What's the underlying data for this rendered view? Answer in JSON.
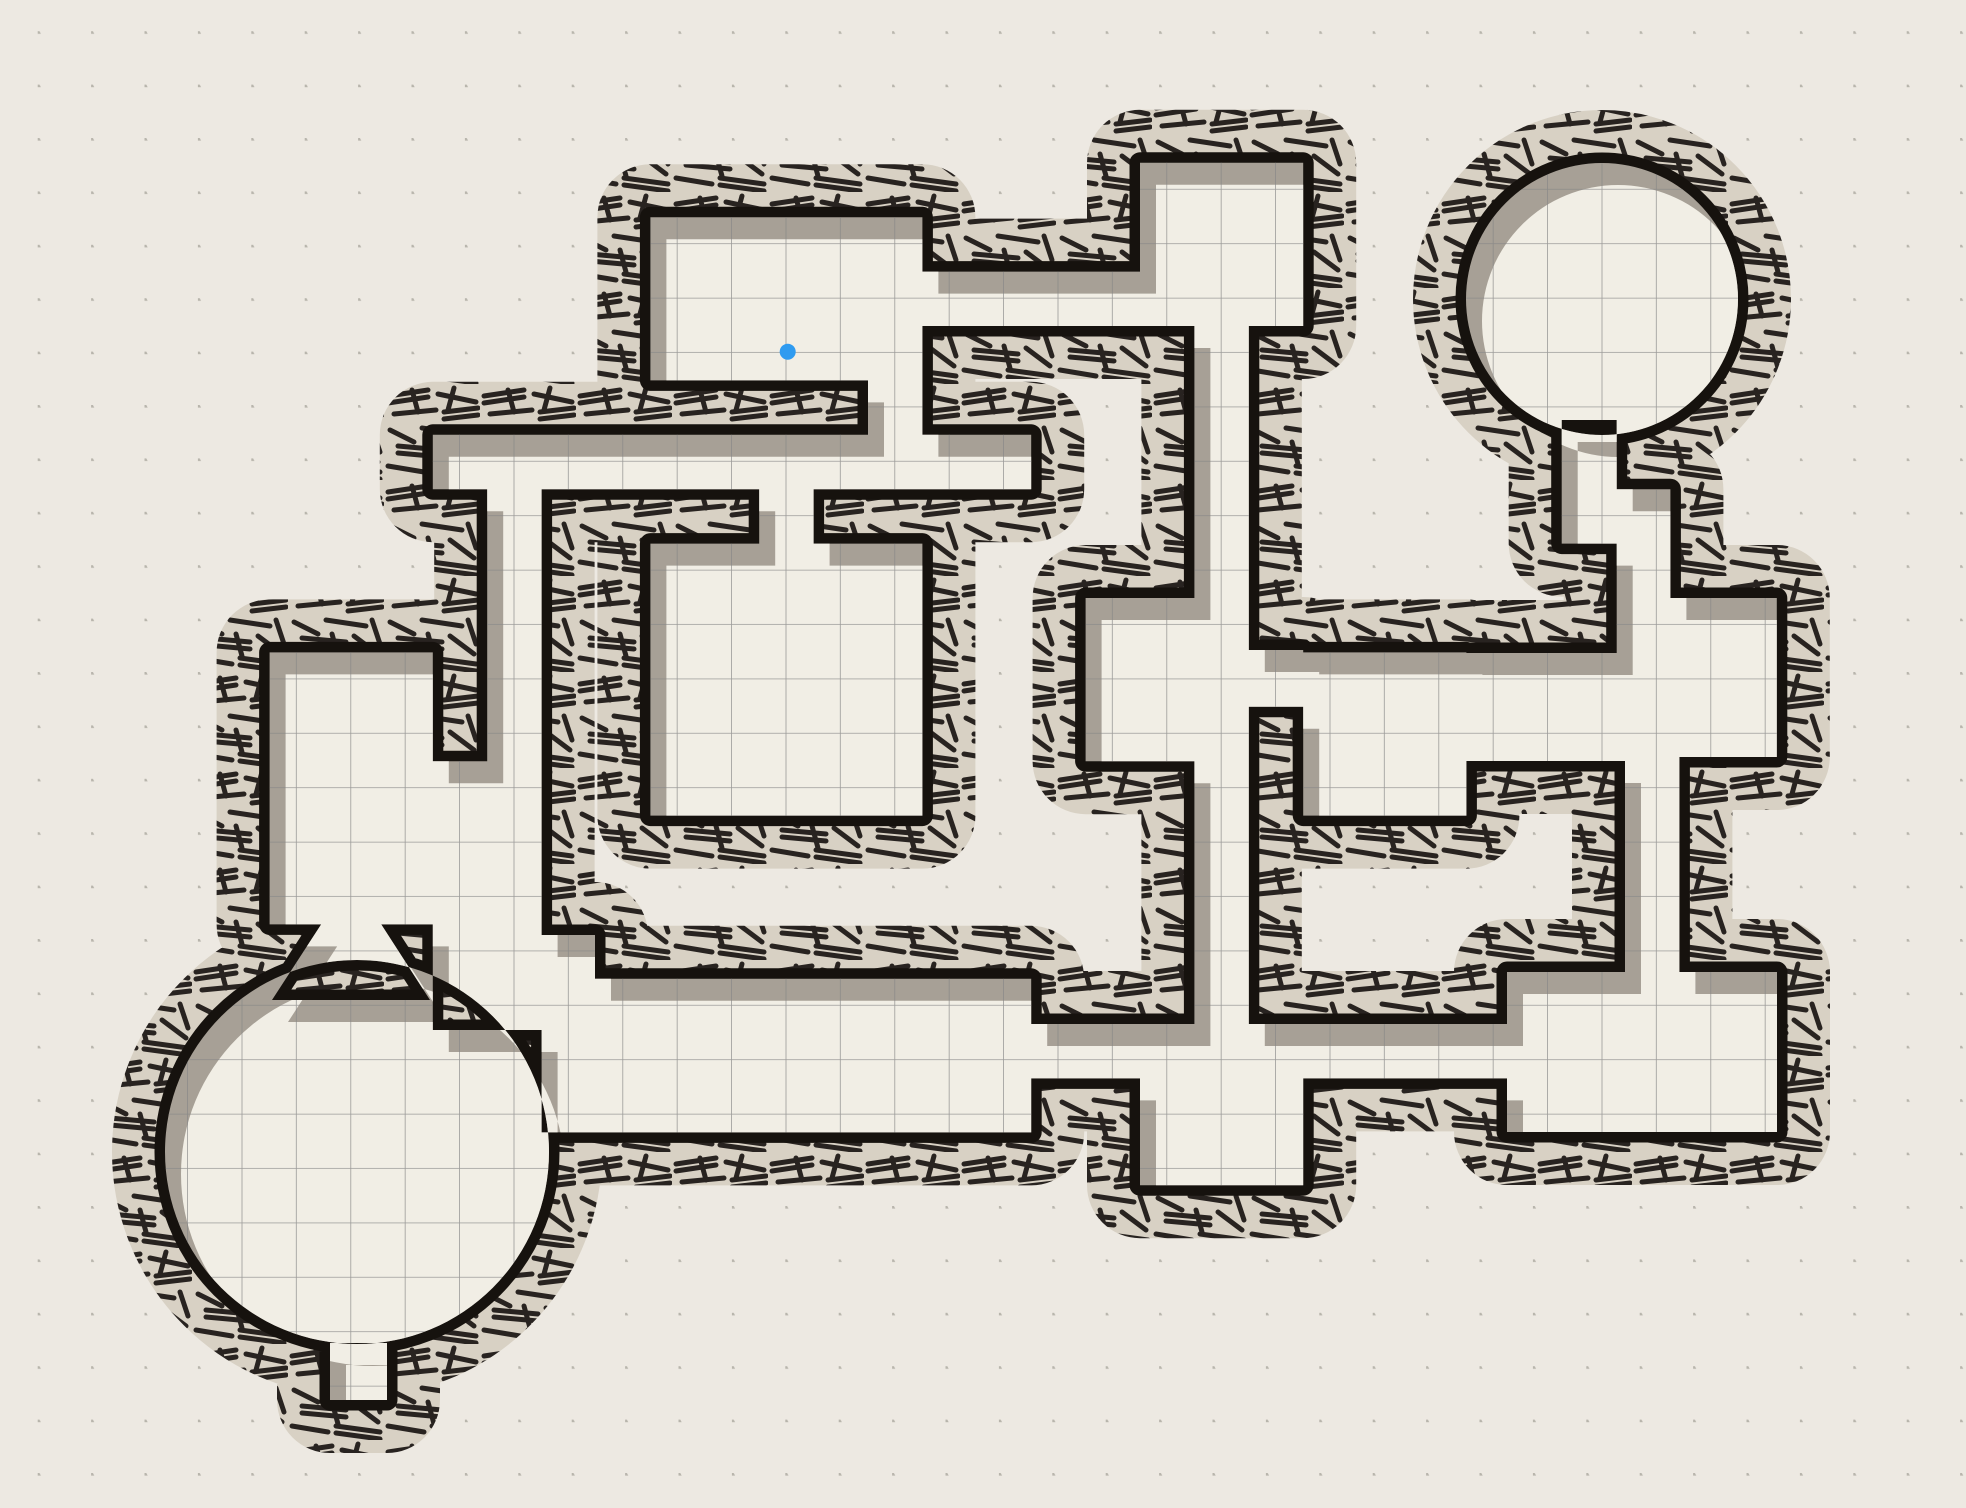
{
  "app": {
    "title": "dungeon-map-canvas",
    "view": "hand-drawn dungeon floor plan on dotted paper"
  },
  "canvas": {
    "width": 1966,
    "height": 1508
  },
  "palette": {
    "background": "#EDE9E2",
    "floor": "#F1EEE5",
    "grid_line": "#868686",
    "wall_ink": "#16120E",
    "hatch_base": "#D8D1C4",
    "hatch_stroke": "#282320",
    "inner_shadow": "#A7A096",
    "drop_shadow": "rgba(74,63,50,0.32)",
    "dot_color": "#B3AFA7",
    "marker_blue": "#2F9BF0"
  },
  "grid": {
    "cell": 54.4,
    "line_offset_x": 24.8,
    "line_offset_y": 26.5,
    "dot_spacing": 53.4,
    "dot_offset_x": 37.7,
    "dot_offset_y": 31.2
  },
  "marker": {
    "x": 787.7,
    "y": 351.7,
    "radius": 8
  },
  "map": {
    "structures": [
      {
        "type": "rect",
        "name": "room-northwest",
        "x": 650.4,
        "y": 217.2,
        "w": 272.0,
        "h": 163.2
      },
      {
        "type": "rect",
        "name": "passage-nw-east",
        "x": 922.4,
        "y": 271.6,
        "w": 217.6,
        "h": 54.4
      },
      {
        "type": "rect",
        "name": "room-top-center",
        "x": 1140.0,
        "y": 162.8,
        "w": 163.2,
        "h": 163.2
      },
      {
        "type": "rect",
        "name": "corridor-center-upper",
        "x": 1194.4,
        "y": 326.0,
        "w": 54.4,
        "h": 272.0
      },
      {
        "type": "rect",
        "name": "passage-nw-south-door",
        "x": 868.0,
        "y": 380.4,
        "w": 54.4,
        "h": 54.4
      },
      {
        "type": "rect",
        "name": "corridor-west-east",
        "x": 432.8,
        "y": 434.8,
        "w": 598.4,
        "h": 54.4
      },
      {
        "type": "rect",
        "name": "door-square-room-north",
        "x": 759.2,
        "y": 489.2,
        "w": 54.4,
        "h": 54.4
      },
      {
        "type": "rect",
        "name": "room-square-center-west",
        "x": 650.4,
        "y": 543.6,
        "w": 272.0,
        "h": 272.0
      },
      {
        "type": "rect",
        "name": "room-west-tall",
        "x": 269.6,
        "y": 652.4,
        "w": 163.2,
        "h": 272.0
      },
      {
        "type": "rect",
        "name": "corridor-west-vertical",
        "x": 487.2,
        "y": 489.2,
        "w": 54.4,
        "h": 272.0
      },
      {
        "type": "rect",
        "name": "corridor-west-widening",
        "x": 432.8,
        "y": 761.2,
        "w": 108.8,
        "h": 173.8
      },
      {
        "type": "rect",
        "name": "junction-southwest",
        "x": 432.8,
        "y": 935.0,
        "w": 162.2,
        "h": 95.0
      },
      {
        "type": "rect",
        "name": "room-bottom-left-hall",
        "x": 541.6,
        "y": 978.8,
        "w": 489.6,
        "h": 153.6
      },
      {
        "type": "rect",
        "name": "corridor-bottom-row",
        "x": 1031.2,
        "y": 1024.0,
        "w": 475.8,
        "h": 54.4
      },
      {
        "type": "rect",
        "name": "alcove-bottom-center",
        "x": 1140.0,
        "y": 1078.4,
        "w": 163.2,
        "h": 106.8
      },
      {
        "type": "rect",
        "name": "corridor-center-lower",
        "x": 1194.4,
        "y": 761.2,
        "w": 54.4,
        "h": 262.8
      },
      {
        "type": "rect",
        "name": "hall-center",
        "x": 1085.6,
        "y": 598.0,
        "w": 163.2,
        "h": 163.2
      },
      {
        "type": "rect",
        "name": "door-hall-east",
        "x": 1248.8,
        "y": 650.0,
        "w": 54.4,
        "h": 56.8
      },
      {
        "type": "rect",
        "name": "room-center-east",
        "x": 1303.2,
        "y": 652.4,
        "w": 163.2,
        "h": 163.2
      },
      {
        "type": "rect",
        "name": "passage-center-to-east",
        "x": 1466.4,
        "y": 653.0,
        "w": 163.2,
        "h": 108.0
      },
      {
        "type": "rect",
        "name": "room-east",
        "x": 1629.6,
        "y": 598.0,
        "w": 147.2,
        "h": 159.0
      },
      {
        "type": "rect",
        "name": "stem-ne-circle",
        "x": 1561.7,
        "y": 420.0,
        "w": 55.0,
        "h": 69.2
      },
      {
        "type": "rect",
        "name": "passage-ne-jog",
        "x": 1561.7,
        "y": 489.2,
        "w": 108.7,
        "h": 54.4
      },
      {
        "type": "rect",
        "name": "corridor-ne-south",
        "x": 1616.7,
        "y": 543.6,
        "w": 53.7,
        "h": 109.4
      },
      {
        "type": "rect",
        "name": "corridor-east-vertical",
        "x": 1625.0,
        "y": 757.0,
        "w": 54.4,
        "h": 215.0
      },
      {
        "type": "rect",
        "name": "room-bottom-right",
        "x": 1507.0,
        "y": 972.0,
        "w": 270.0,
        "h": 160.0
      },
      {
        "type": "rect",
        "name": "alcove-circle-south",
        "x": 330.0,
        "y": 1343.0,
        "w": 57.0,
        "h": 57.0
      },
      {
        "type": "circle",
        "name": "round-chamber-southwest",
        "cx": 357.0,
        "cy": 1152.0,
        "r": 192.0
      },
      {
        "type": "circle",
        "name": "round-chamber-northeast",
        "cx": 1602.0,
        "cy": 299.0,
        "r": 136.0
      },
      {
        "type": "polygon",
        "name": "funnel-west-room-to-circle",
        "points": [
          [
            324.0,
            920.0
          ],
          [
            378.4,
            920.0
          ],
          [
            430.0,
            1000.0
          ],
          [
            272.0,
            1000.0
          ]
        ]
      }
    ]
  }
}
